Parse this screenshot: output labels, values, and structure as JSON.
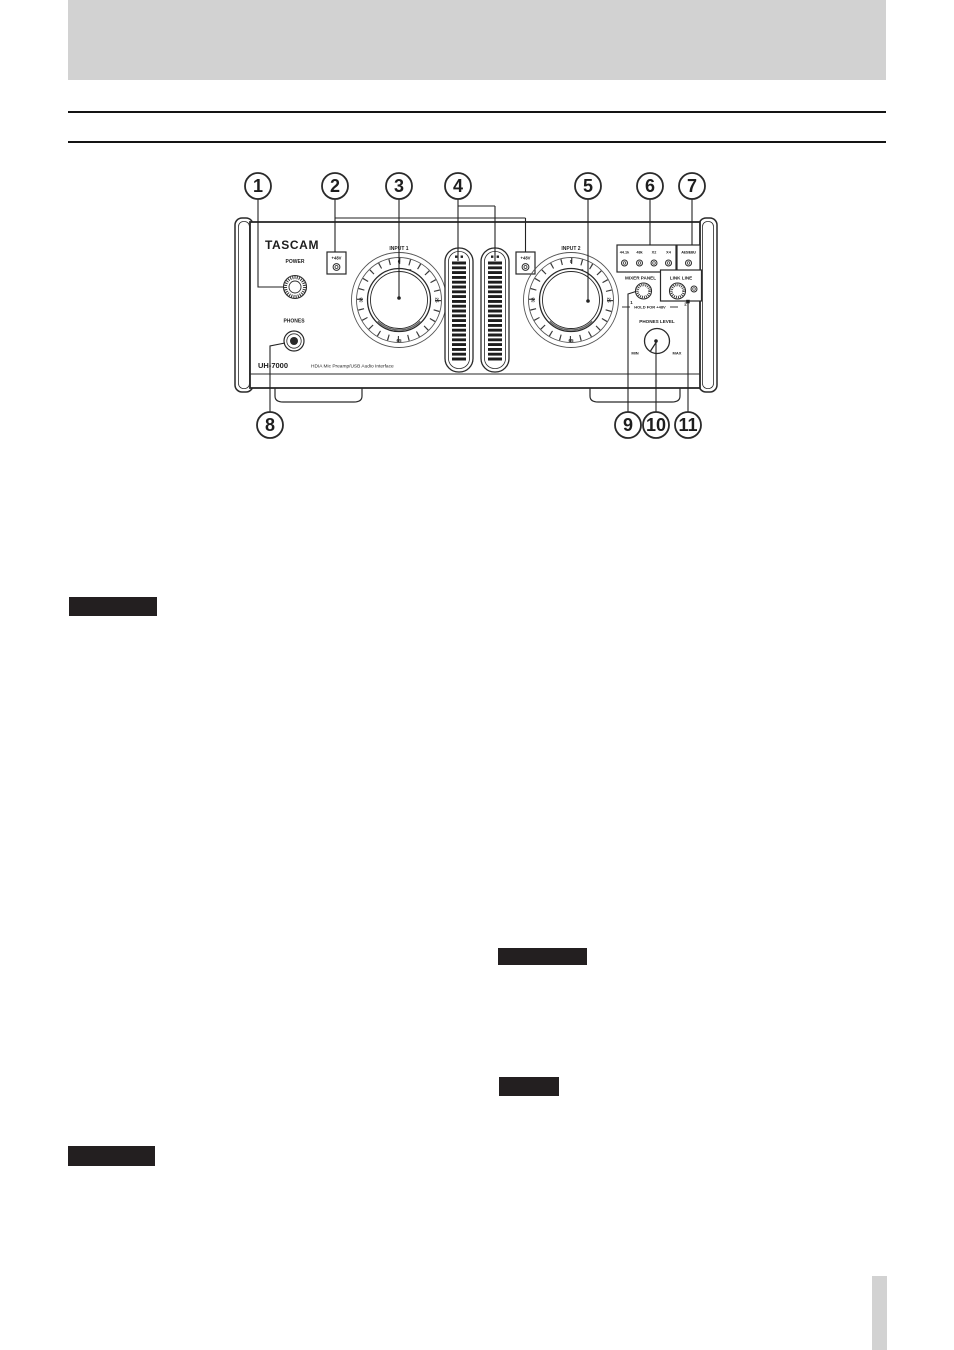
{
  "page": {
    "description": "Manual page: front panel diagram of audio interface with numbered callouts",
    "colors": {
      "header_bar": "#d2d2d2",
      "rule": "#141414",
      "badge_fill": "#231f20",
      "line_art": "#222222"
    }
  },
  "figure": {
    "callouts": [
      "1",
      "2",
      "3",
      "4",
      "5",
      "6",
      "7",
      "8",
      "9",
      "10",
      "11"
    ],
    "panel": {
      "brand": "TASCAM",
      "model": "UH-7000",
      "tagline": "HDIA Mic Preamp/USB Audio Interface",
      "power_label": "POWER",
      "phones_label": "PHONES",
      "phantom_label_1": "+48V",
      "phantom_label_2": "+48V",
      "input1_label": "INPUT 1",
      "input2_label": "INPUT 2",
      "knob_scale": {
        "top": "0",
        "upper": "22",
        "right": "25",
        "bottom": "65",
        "left": "38"
      },
      "rate_indicators": [
        "44.1k",
        "48k",
        "X2",
        "X4"
      ],
      "aes_label": "AES/EBU",
      "mixer_panel_label": "MIXER PANEL",
      "link_line_label": "LINK LINE",
      "ch1": "1",
      "ch2": "2",
      "hold_label": "HOLD FOR +48V",
      "phones_level_label": "PHONES LEVEL",
      "min_label": "MIN",
      "max_label": "MAX"
    }
  }
}
